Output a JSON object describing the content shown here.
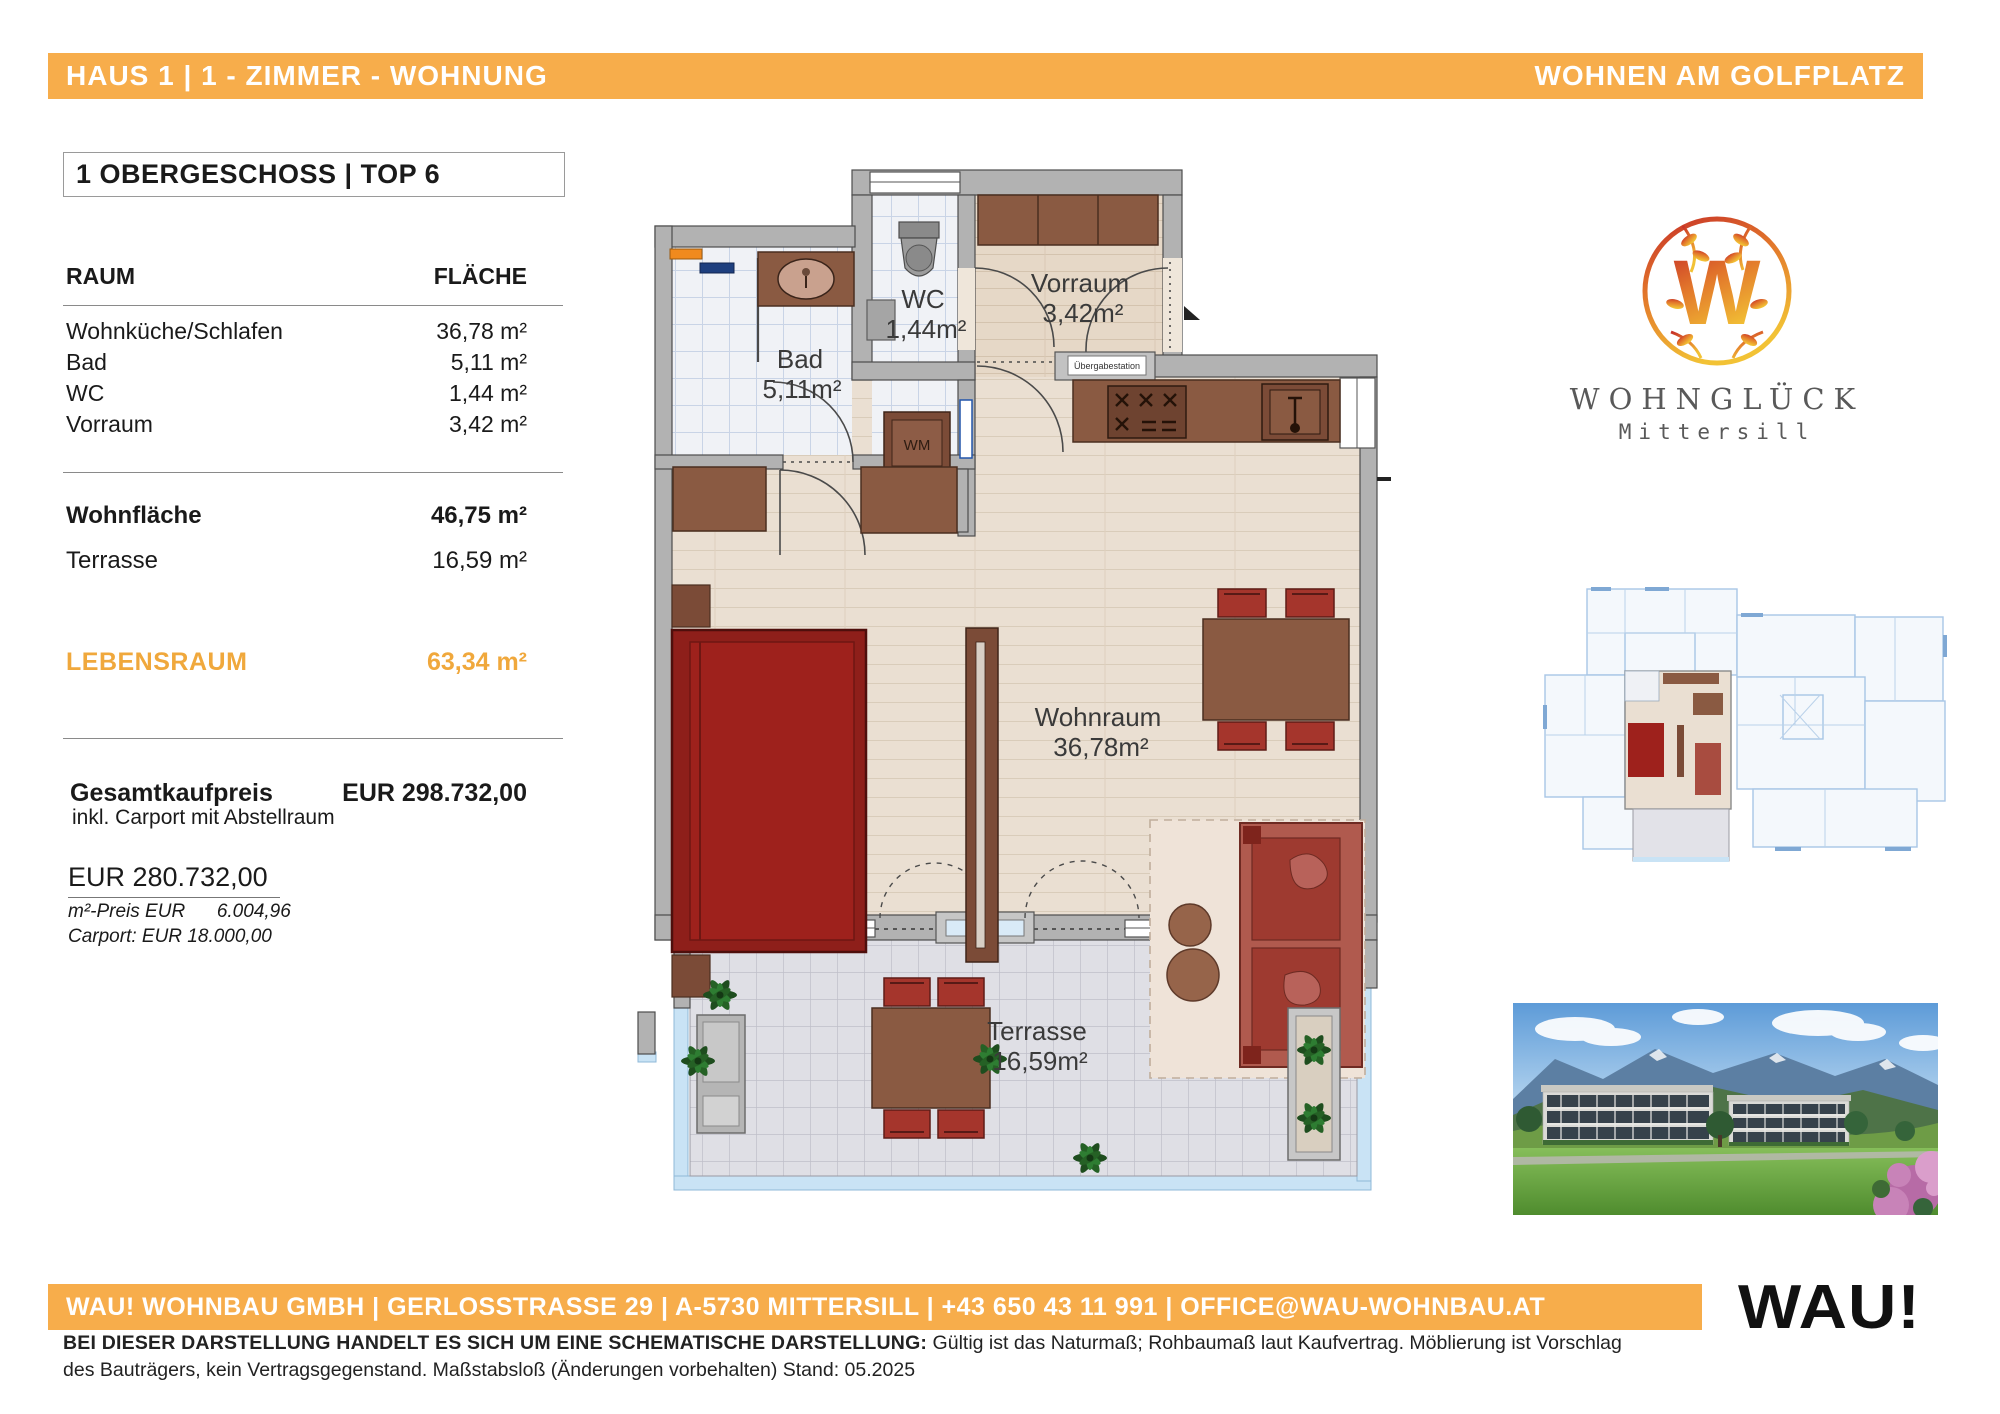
{
  "header": {
    "left": "HAUS 1 | 1 - ZIMMER - WOHNUNG",
    "right": "WOHNEN AM GOLFPLATZ"
  },
  "unit": {
    "title": "1 OBERGESCHOSS | TOP 6"
  },
  "room_table": {
    "col_room": "RAUM",
    "col_area": "FLÄCHE",
    "rooms": [
      {
        "name": "Wohnküche/Schlafen",
        "area": "36,78 m²"
      },
      {
        "name": "Bad",
        "area": "5,11 m²"
      },
      {
        "name": "WC",
        "area": "1,44 m²"
      },
      {
        "name": "Vorraum",
        "area": "3,42 m²"
      }
    ],
    "wohnflaeche_label": "Wohnfläche",
    "wohnflaeche_value": "46,75 m²",
    "terrasse_label": "Terrasse",
    "terrasse_value": "16,59 m²",
    "lebensraum_label": "LEBENSRAUM",
    "lebensraum_value": "63,34 m²"
  },
  "pricing": {
    "total_label": "Gesamtkaufpreis",
    "total_value": "EUR 298.732,00",
    "total_note": "inkl. Carport mit Abstellraum",
    "base_price": "EUR 280.732,00",
    "sqm_price": "m²-Preis EUR      6.004,96",
    "carport_price": "Carport: EUR 18.000,00"
  },
  "floorplan": {
    "bad_name": "Bad",
    "bad_area": "5,11m²",
    "wc_name": "WC",
    "wc_area": "1,44m²",
    "vorraum_name": "Vorraum",
    "vorraum_area": "3,42m²",
    "wohnraum_name": "Wohnraum",
    "wohnraum_area": "36,78m²",
    "terrasse_name": "Terrasse",
    "terrasse_area": "16,59m²",
    "wm_label": "WM",
    "uebergabestation_label": "Übergabestation"
  },
  "branding": {
    "monogram": "W",
    "logo_title": "WOHNGLÜCK",
    "logo_subtitle": "Mittersill"
  },
  "footer_bar": {
    "text": "WAU! WOHNBAU GMBH | GERLOSSTRASSE 29 | A-5730 MITTERSILL | +43 650 43 11 991 | OFFICE@WAU-WOHNBAU.AT",
    "logo": "WAU!"
  },
  "disclaimer": {
    "bold": "BEI DIESER DARSTELLUNG HANDELT ES SICH UM EINE SCHEMATISCHE DARSTELLUNG:",
    "text": " Gültig ist das Naturmaß; Rohbaumaß laut Kaufvertrag. Möblierung ist Vorschlag des Bauträgers, kein Vertragsgegenstand. Maßstabsloß (Änderungen vorbehalten) Stand: 05.2025"
  },
  "colors": {
    "accent_orange": "#F7AD4B",
    "lebensraum_orange": "#F0A83C",
    "wall_gray": "#B2B2B2",
    "furniture_brown": "#8A5A42",
    "furniture_red": "#9E211C"
  }
}
